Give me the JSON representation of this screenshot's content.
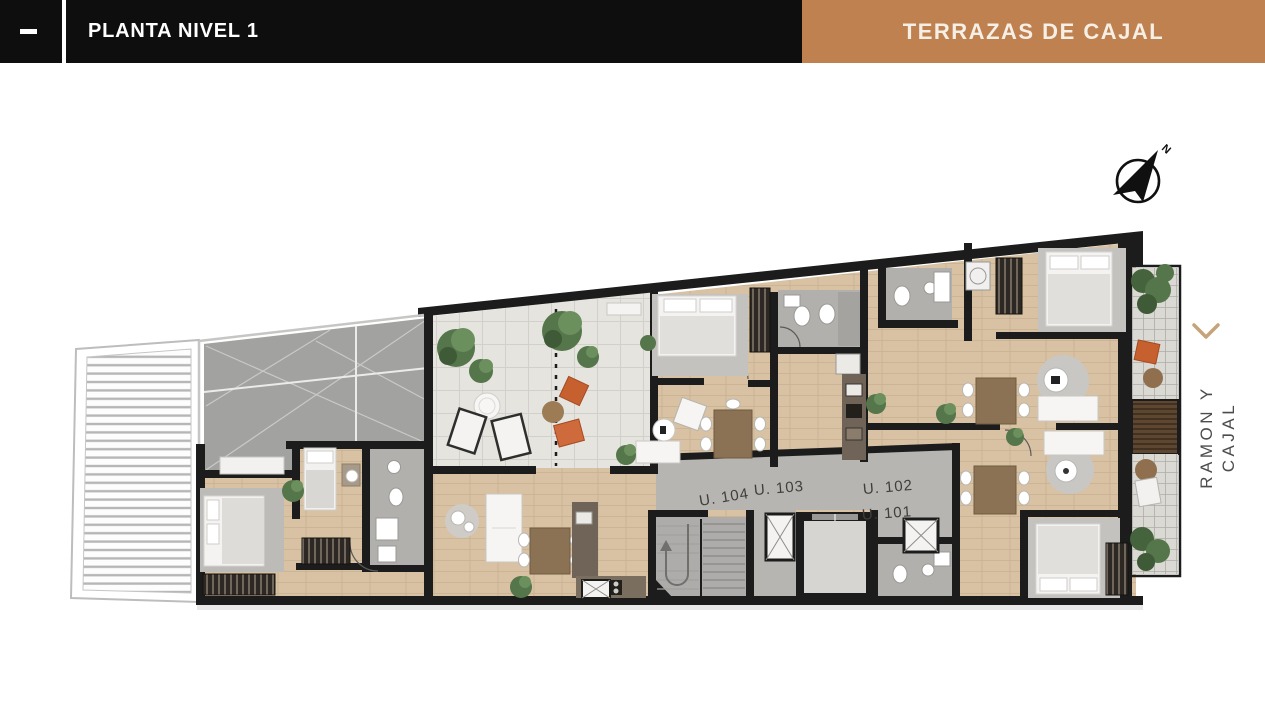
{
  "header": {
    "title": "PLANTA NIVEL 1",
    "project_title": "TERRAZAS DE CAJAL"
  },
  "compass": {
    "north_label": "N"
  },
  "street": {
    "name": "RAMON Y CAJAL"
  },
  "plan": {
    "units": [
      {
        "id": "U104",
        "label": "U. 104"
      },
      {
        "id": "U103",
        "label": "U. 103"
      },
      {
        "id": "U102",
        "label": "U. 102"
      },
      {
        "id": "U101",
        "label": "U. 101"
      }
    ]
  },
  "colors": {
    "header_bg": "#0e0e0e",
    "accent_brown": "#bf8150",
    "cream_text": "#f6efe5",
    "chevron_tan": "#c7a379",
    "wall_black": "#1c1c1c",
    "wood_floor": "#d8c2a3",
    "terrace_tile": "#e6e4df",
    "corridor_gray": "#b7b5b2",
    "plant_green": "#55754a",
    "accent_orange": "#c6602f"
  }
}
